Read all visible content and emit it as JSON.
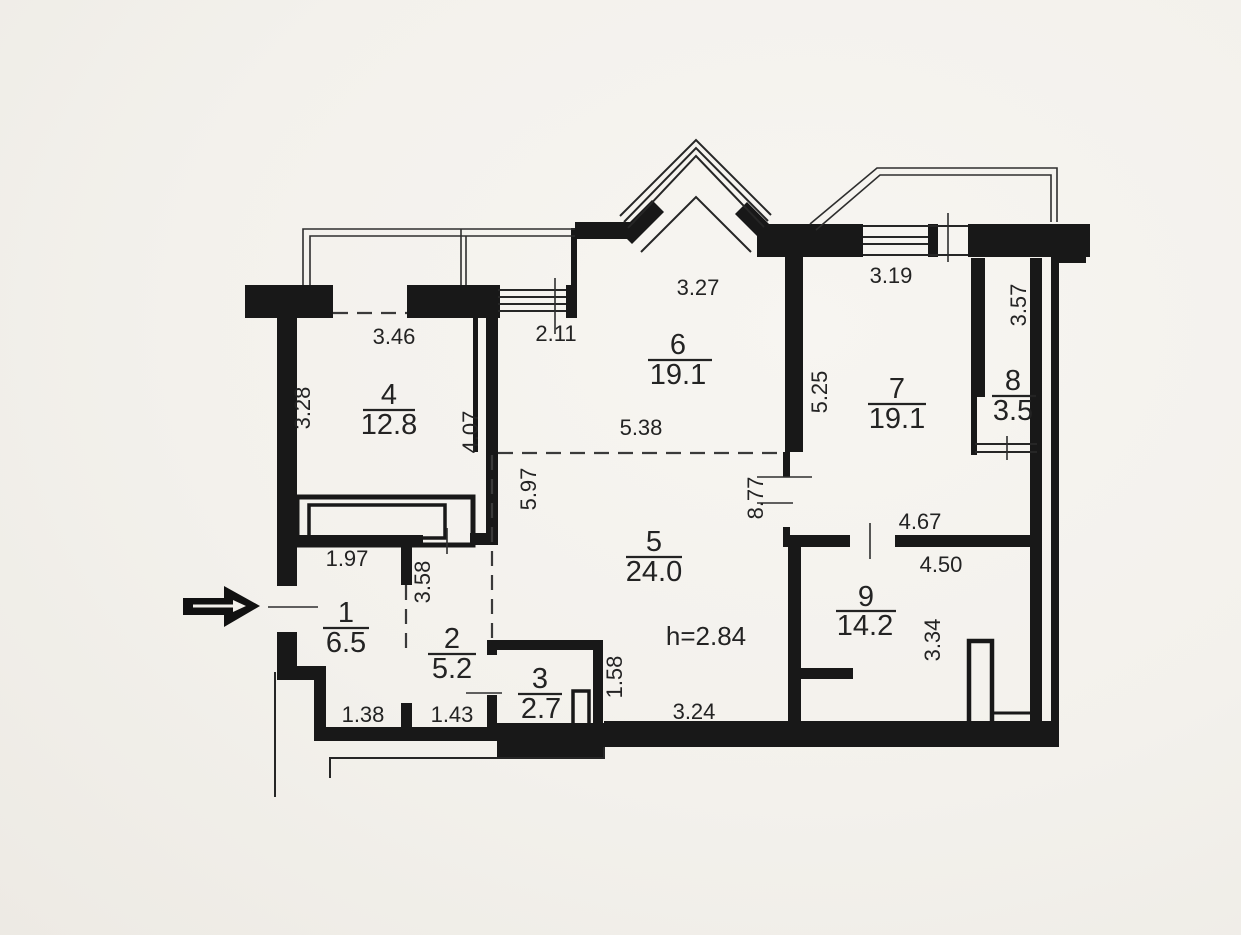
{
  "plan": {
    "type": "apartment-floor-plan",
    "ceiling_height": "h=2.84",
    "entrance_marker": "entrance-arrow",
    "rooms": [
      {
        "number": "1",
        "area": "6.5"
      },
      {
        "number": "2",
        "area": "5.2"
      },
      {
        "number": "3",
        "area": "2.7"
      },
      {
        "number": "4",
        "area": "12.8"
      },
      {
        "number": "5",
        "area": "24.0"
      },
      {
        "number": "6",
        "area": "19.1"
      },
      {
        "number": "7",
        "area": "19.1"
      },
      {
        "number": "8",
        "area": "3.5"
      },
      {
        "number": "9",
        "area": "14.2"
      }
    ],
    "dimensions": {
      "d346": "3.46",
      "d211": "2.11",
      "d327": "3.27",
      "d319": "3.19",
      "d357": "3.57",
      "d328": "3.28",
      "d407": "4.07",
      "d538": "5.38",
      "d597": "5.97",
      "d525": "5.25",
      "d877": "8.77",
      "d467": "4.67",
      "d450": "4.50",
      "d334": "3.34",
      "d197": "1.97",
      "d358": "3.58",
      "d158": "1.58",
      "d138": "1.38",
      "d143": "1.43",
      "d324": "3.24"
    },
    "colors": {
      "paper": "#f3f1ec",
      "ink": "#181818"
    }
  }
}
